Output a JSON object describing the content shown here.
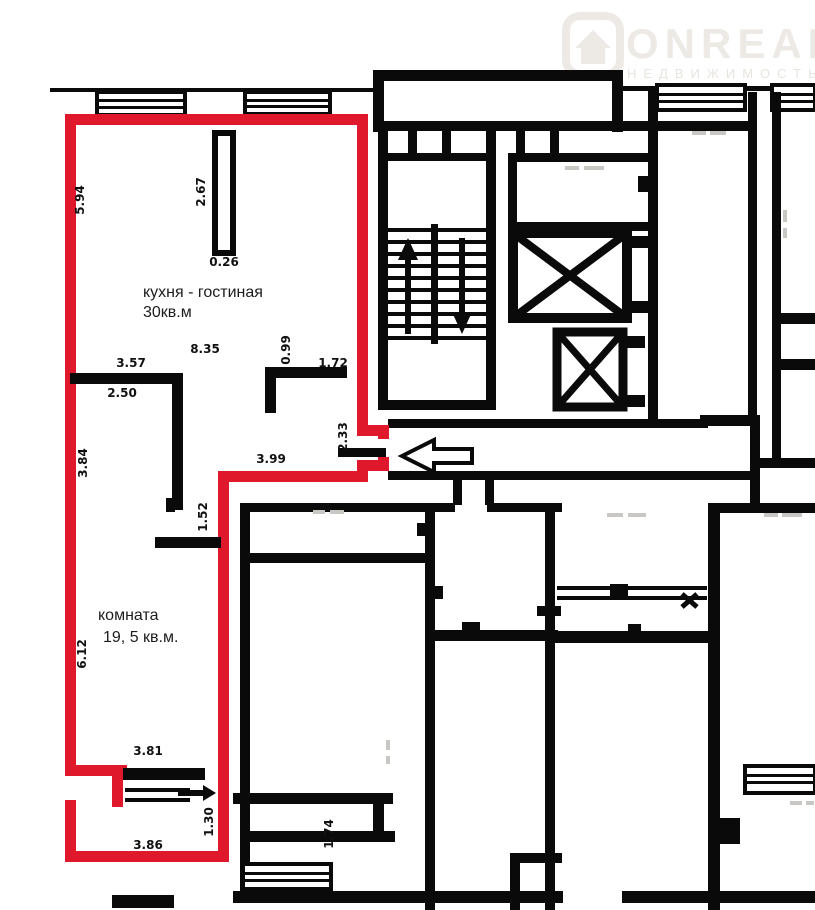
{
  "watermark": {
    "brand": "ONREALT",
    "subtitle": "НЕДВИЖИМОСТЬ",
    "icon": "house-logo-icon"
  },
  "apartment": {
    "outline_color": "#e0182b",
    "rooms": [
      {
        "name": "кухня - гостиная",
        "area": "30кв.м"
      },
      {
        "name": "комната",
        "area": "19, 5 кв.м."
      }
    ]
  },
  "plan": {
    "wall_color": "#0a0a0a",
    "background": "#ffffff",
    "symbols": [
      "staircase",
      "elevator-shaft-x",
      "windows",
      "entrance-arrow"
    ]
  },
  "dimensions": [
    {
      "label": "5.94",
      "x": 84,
      "y": 200,
      "rotated": true
    },
    {
      "label": "2.67",
      "x": 205,
      "y": 192,
      "rotated": true
    },
    {
      "label": "0.26",
      "x": 224,
      "y": 266,
      "rotated": false
    },
    {
      "label": "8.35",
      "x": 205,
      "y": 353,
      "rotated": false
    },
    {
      "label": "3.57",
      "x": 131,
      "y": 367,
      "rotated": false
    },
    {
      "label": "2.50",
      "x": 122,
      "y": 397,
      "rotated": false
    },
    {
      "label": "3.84",
      "x": 87,
      "y": 463,
      "rotated": true
    },
    {
      "label": "0.99",
      "x": 290,
      "y": 350,
      "rotated": true
    },
    {
      "label": "1.72",
      "x": 333,
      "y": 367,
      "rotated": false
    },
    {
      "label": "2.33",
      "x": 347,
      "y": 437,
      "rotated": true
    },
    {
      "label": "3.99",
      "x": 271,
      "y": 463,
      "rotated": false
    },
    {
      "label": "1.52",
      "x": 207,
      "y": 517,
      "rotated": true
    },
    {
      "label": "6.12",
      "x": 86,
      "y": 654,
      "rotated": true
    },
    {
      "label": "3.81",
      "x": 148,
      "y": 755,
      "rotated": false
    },
    {
      "label": "1.30",
      "x": 213,
      "y": 822,
      "rotated": true
    },
    {
      "label": "3.86",
      "x": 148,
      "y": 849,
      "rotated": false
    },
    {
      "label": "1.74",
      "x": 333,
      "y": 834,
      "rotated": true
    }
  ]
}
